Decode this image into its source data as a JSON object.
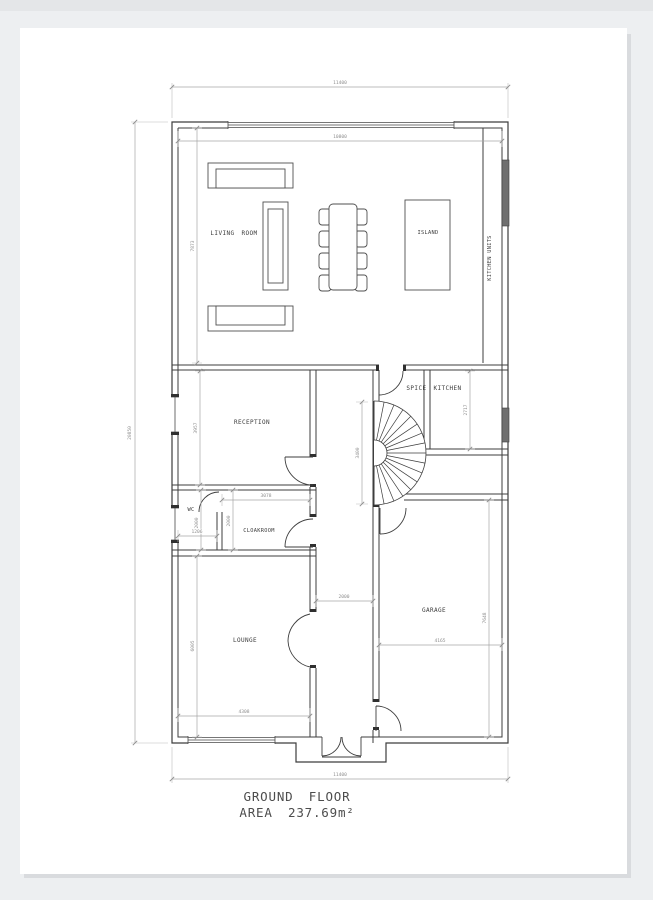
{
  "title": {
    "line1": "GROUND FLOOR",
    "line2": "AREA 237.69m²"
  },
  "rooms": {
    "living_room": "LIVING ROOM",
    "island": "ISLAND",
    "kitchen_units": "KITCHEN UNITS",
    "spice_kitchen": "SPICE KITCHEN",
    "reception": "RECEPTION",
    "wc": "WC",
    "cloakroom": "CLOAKROOM",
    "lounge": "LOUNGE",
    "garage": "GARAGE"
  },
  "dimensions": {
    "overall_width_top": "11400",
    "overall_width_bottom": "11400",
    "overall_height_left": "20850",
    "living_width": "10800",
    "living_height": "7873",
    "reception_height": "3957",
    "spice_kitchen_height": "2717",
    "stair_height": "3400",
    "wc_height": "2000",
    "wc_width": "1206",
    "cloakroom_width": "3078",
    "cloakroom_height": "2000",
    "hall_width": "2000",
    "lounge_height": "6005",
    "lounge_width": "4308",
    "garage_width": "4165",
    "garage_height": "7648"
  },
  "colors": {
    "background": "#edeff1",
    "paper": "#ffffff",
    "wall_line": "#3d3d3d",
    "dimension_line": "#a6a6a6",
    "dimension_text": "#8f8f8f",
    "window_fill": "#6f6f6f",
    "title_text": "#4d4d4d"
  }
}
